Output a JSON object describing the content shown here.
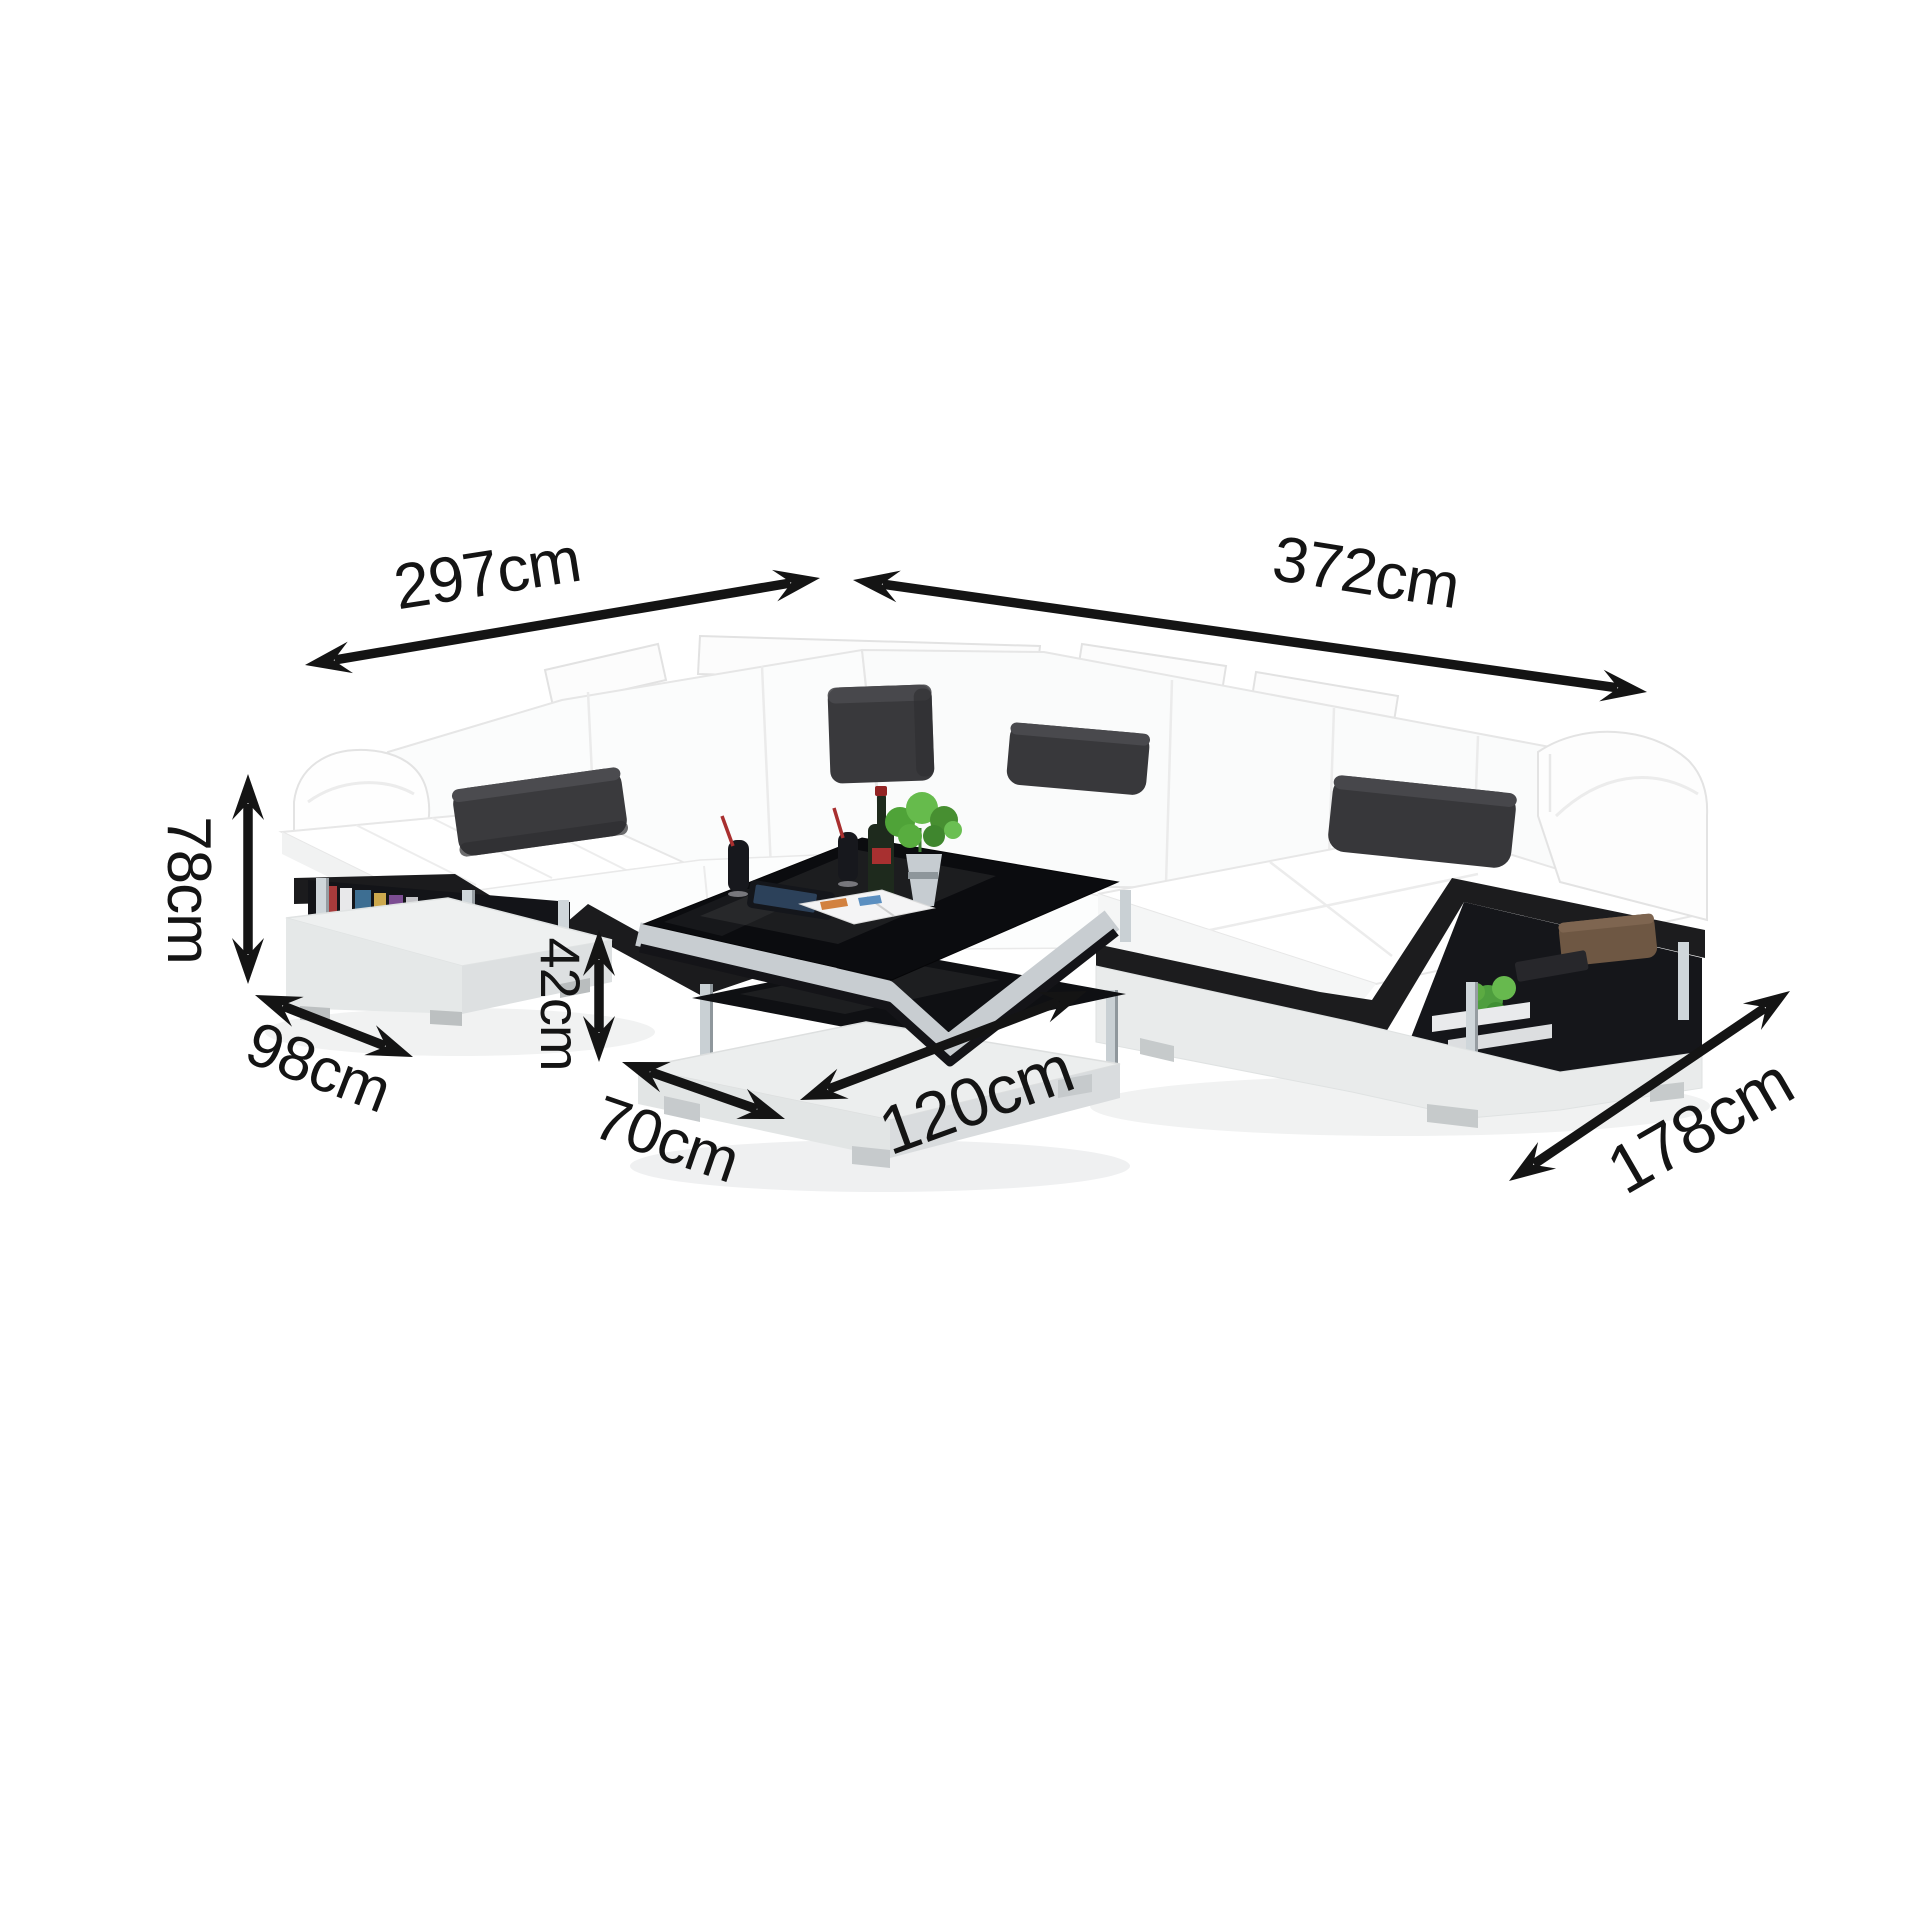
{
  "diagram": {
    "kind": "furniture-dimension-diagram",
    "background": "#ffffff"
  },
  "dimensions": {
    "back_left_width": "297cm",
    "back_right_width": "372cm",
    "backrest_height": "78cm",
    "left_section_depth": "98cm",
    "table_height": "42cm",
    "table_depth": "70cm",
    "table_length": "120cm",
    "chaise_depth": "178cm"
  },
  "colors": {
    "arrow": "#141414",
    "label_text": "#141414",
    "sofa_body": "#ffffff",
    "sofa_shade": "#f1f2f2",
    "accent_stripe": "#1c1c1e",
    "pillow_black": "#39393c",
    "shelf_interior": "#141518",
    "base_grey": "#eceeee",
    "chrome": "#cfd6da",
    "glass_black": "#0b0c0f",
    "plant_green": "#4e9e3e",
    "wine_cap_red": "#932424",
    "blanket_brown": "#6e5743"
  },
  "scene": {
    "parts": [
      "left-backrest",
      "corner-backrest",
      "right-backrest",
      "left-arm",
      "right-arm",
      "left-storage-shelf",
      "chaise-with-storage",
      "corner-pillow",
      "lumbar-pillows",
      "coffee-table",
      "table-decor"
    ]
  }
}
